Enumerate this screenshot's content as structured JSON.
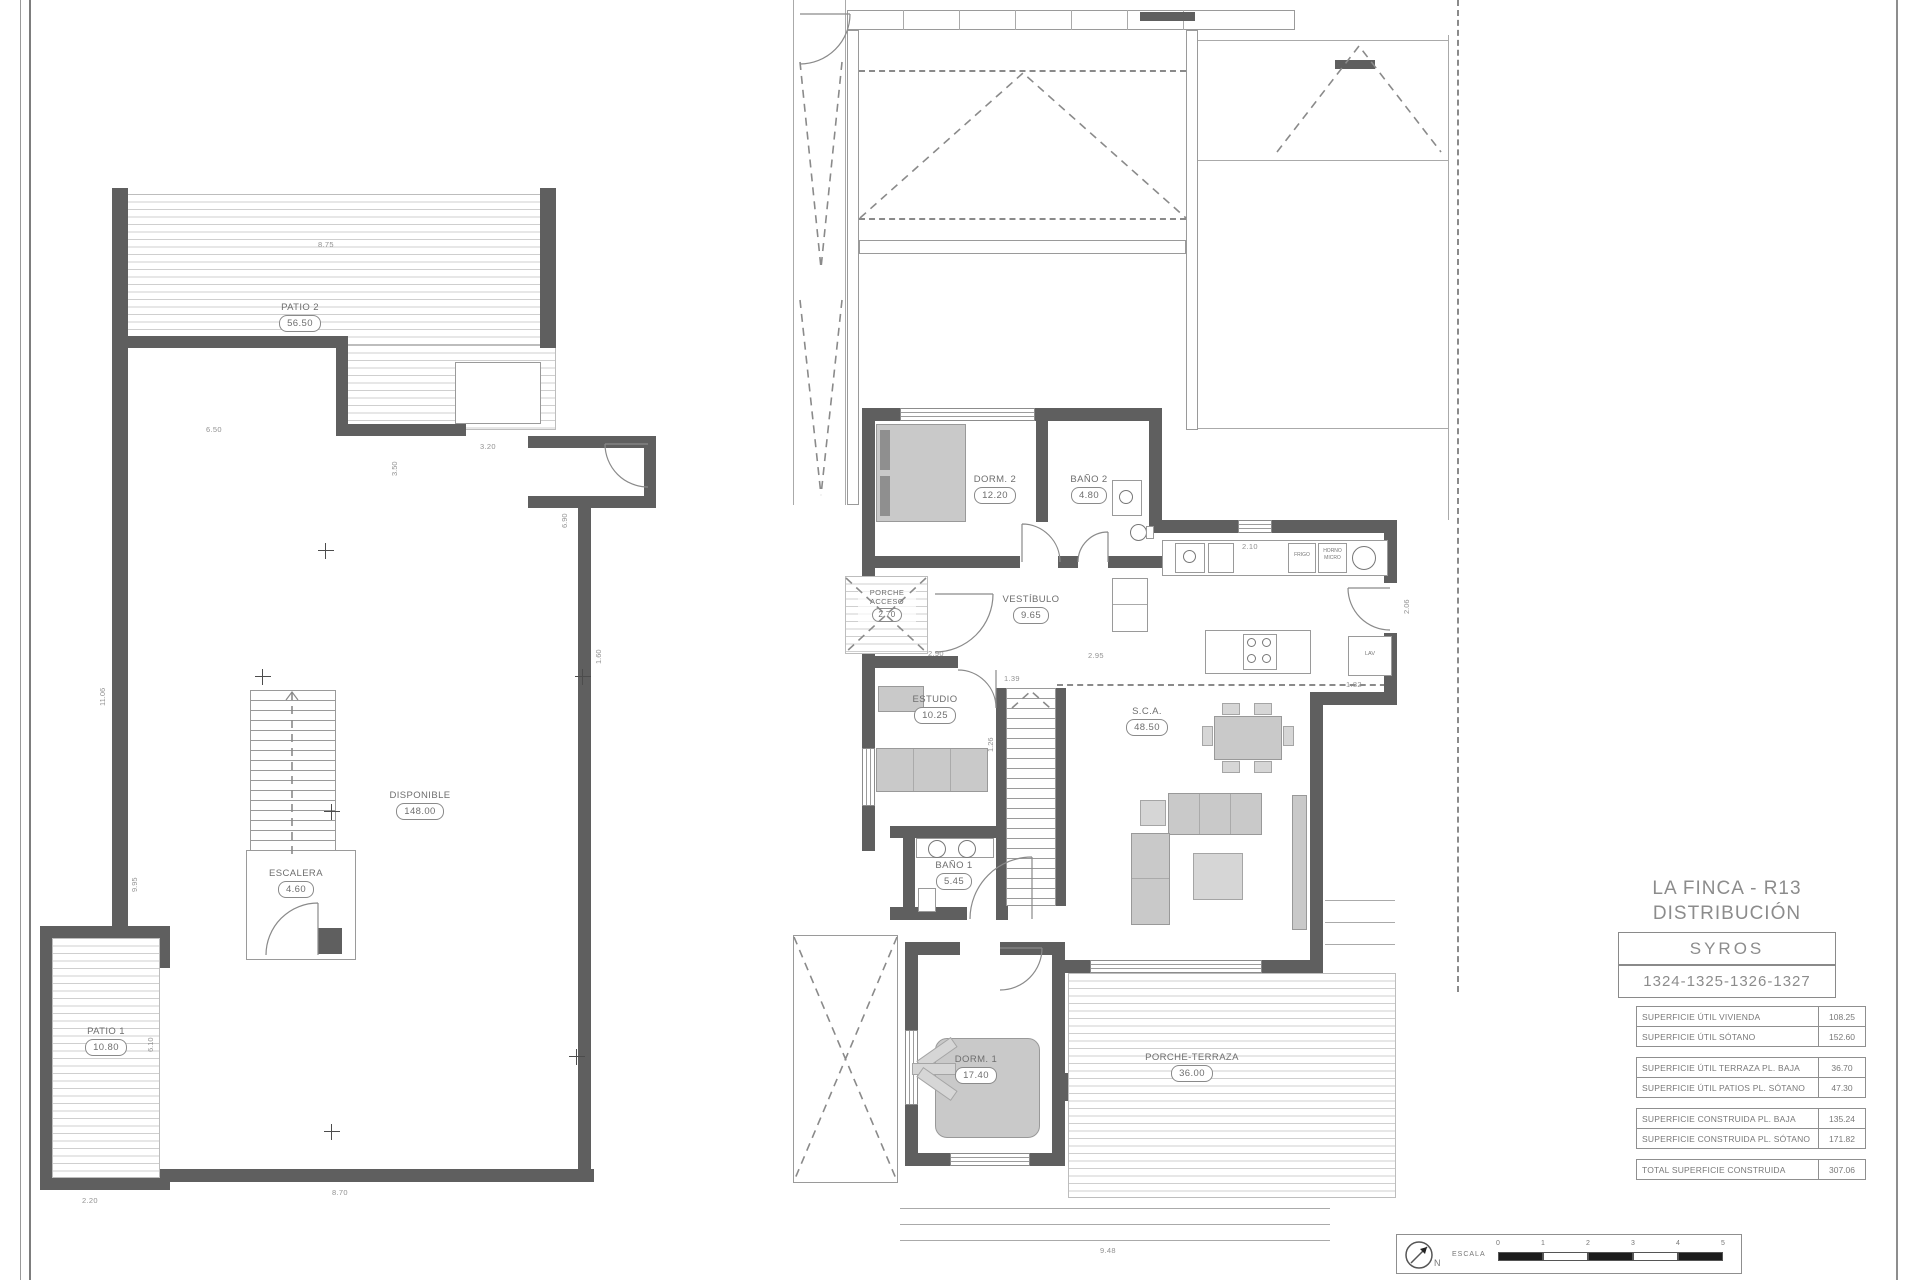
{
  "plans": {
    "basement": {
      "rooms": [
        {
          "name": "PATIO 2",
          "area": "56.50"
        },
        {
          "name": "DISPONIBLE",
          "area": "148.00"
        },
        {
          "name": "ESCALERA",
          "area": "4.60"
        },
        {
          "name": "PATIO 1",
          "area": "10.80"
        }
      ],
      "dims": [
        "8.75",
        "6.50",
        "3.50",
        "3.20",
        "6.90",
        "1.60",
        "11.06",
        "9.95",
        "6.10",
        "2.20",
        "8.70"
      ]
    },
    "ground": {
      "rooms": [
        {
          "name": "DORM. 2",
          "area": "12.20"
        },
        {
          "name": "BAÑO 2",
          "area": "4.80"
        },
        {
          "name": "PORCHE ACCESO",
          "area": "2.70"
        },
        {
          "name": "VESTÍBULO",
          "area": "9.65"
        },
        {
          "name": "ESTUDIO",
          "area": "10.25"
        },
        {
          "name": "S.C.A.",
          "area": "48.50"
        },
        {
          "name": "BAÑO 1",
          "area": "5.45"
        },
        {
          "name": "DORM. 1",
          "area": "17.40"
        },
        {
          "name": "PORCHE-TERRAZA",
          "area": "36.00"
        }
      ],
      "appliances": {
        "fridge": "FRIGO",
        "oven": "HORNO",
        "micro": "MICRO",
        "laundry": "LAV"
      },
      "dims": [
        "2.10",
        "2.06",
        "1.82",
        "2.90",
        "2.95",
        "1.39",
        "1.26",
        "9.48"
      ]
    }
  },
  "title_block": {
    "project": "LA FINCA - R13",
    "drawing": "DISTRIBUCIÓN",
    "model": "SYROS",
    "plots": "1324-1325-1326-1327"
  },
  "area_table": {
    "groups": [
      {
        "rows": [
          {
            "label": "SUPERFICIE ÚTIL VIVIENDA",
            "value": "108.25"
          },
          {
            "label": "SUPERFICIE ÚTIL SÓTANO",
            "value": "152.60"
          }
        ]
      },
      {
        "rows": [
          {
            "label": "SUPERFICIE ÚTIL TERRAZA PL. BAJA",
            "value": "36.70"
          },
          {
            "label": "SUPERFICIE ÚTIL PATIOS PL. SÓTANO",
            "value": "47.30"
          }
        ]
      },
      {
        "rows": [
          {
            "label": "SUPERFICIE CONSTRUIDA PL. BAJA",
            "value": "135.24"
          },
          {
            "label": "SUPERFICIE CONSTRUIDA PL. SÓTANO",
            "value": "171.82"
          }
        ]
      },
      {
        "rows": [
          {
            "label": "TOTAL SUPERFICIE CONSTRUIDA",
            "value": "307.06"
          }
        ]
      }
    ]
  },
  "scale_bar": {
    "label": "ESCALA",
    "north": "N",
    "ticks": [
      "0",
      "1",
      "2",
      "3",
      "4",
      "5"
    ]
  }
}
